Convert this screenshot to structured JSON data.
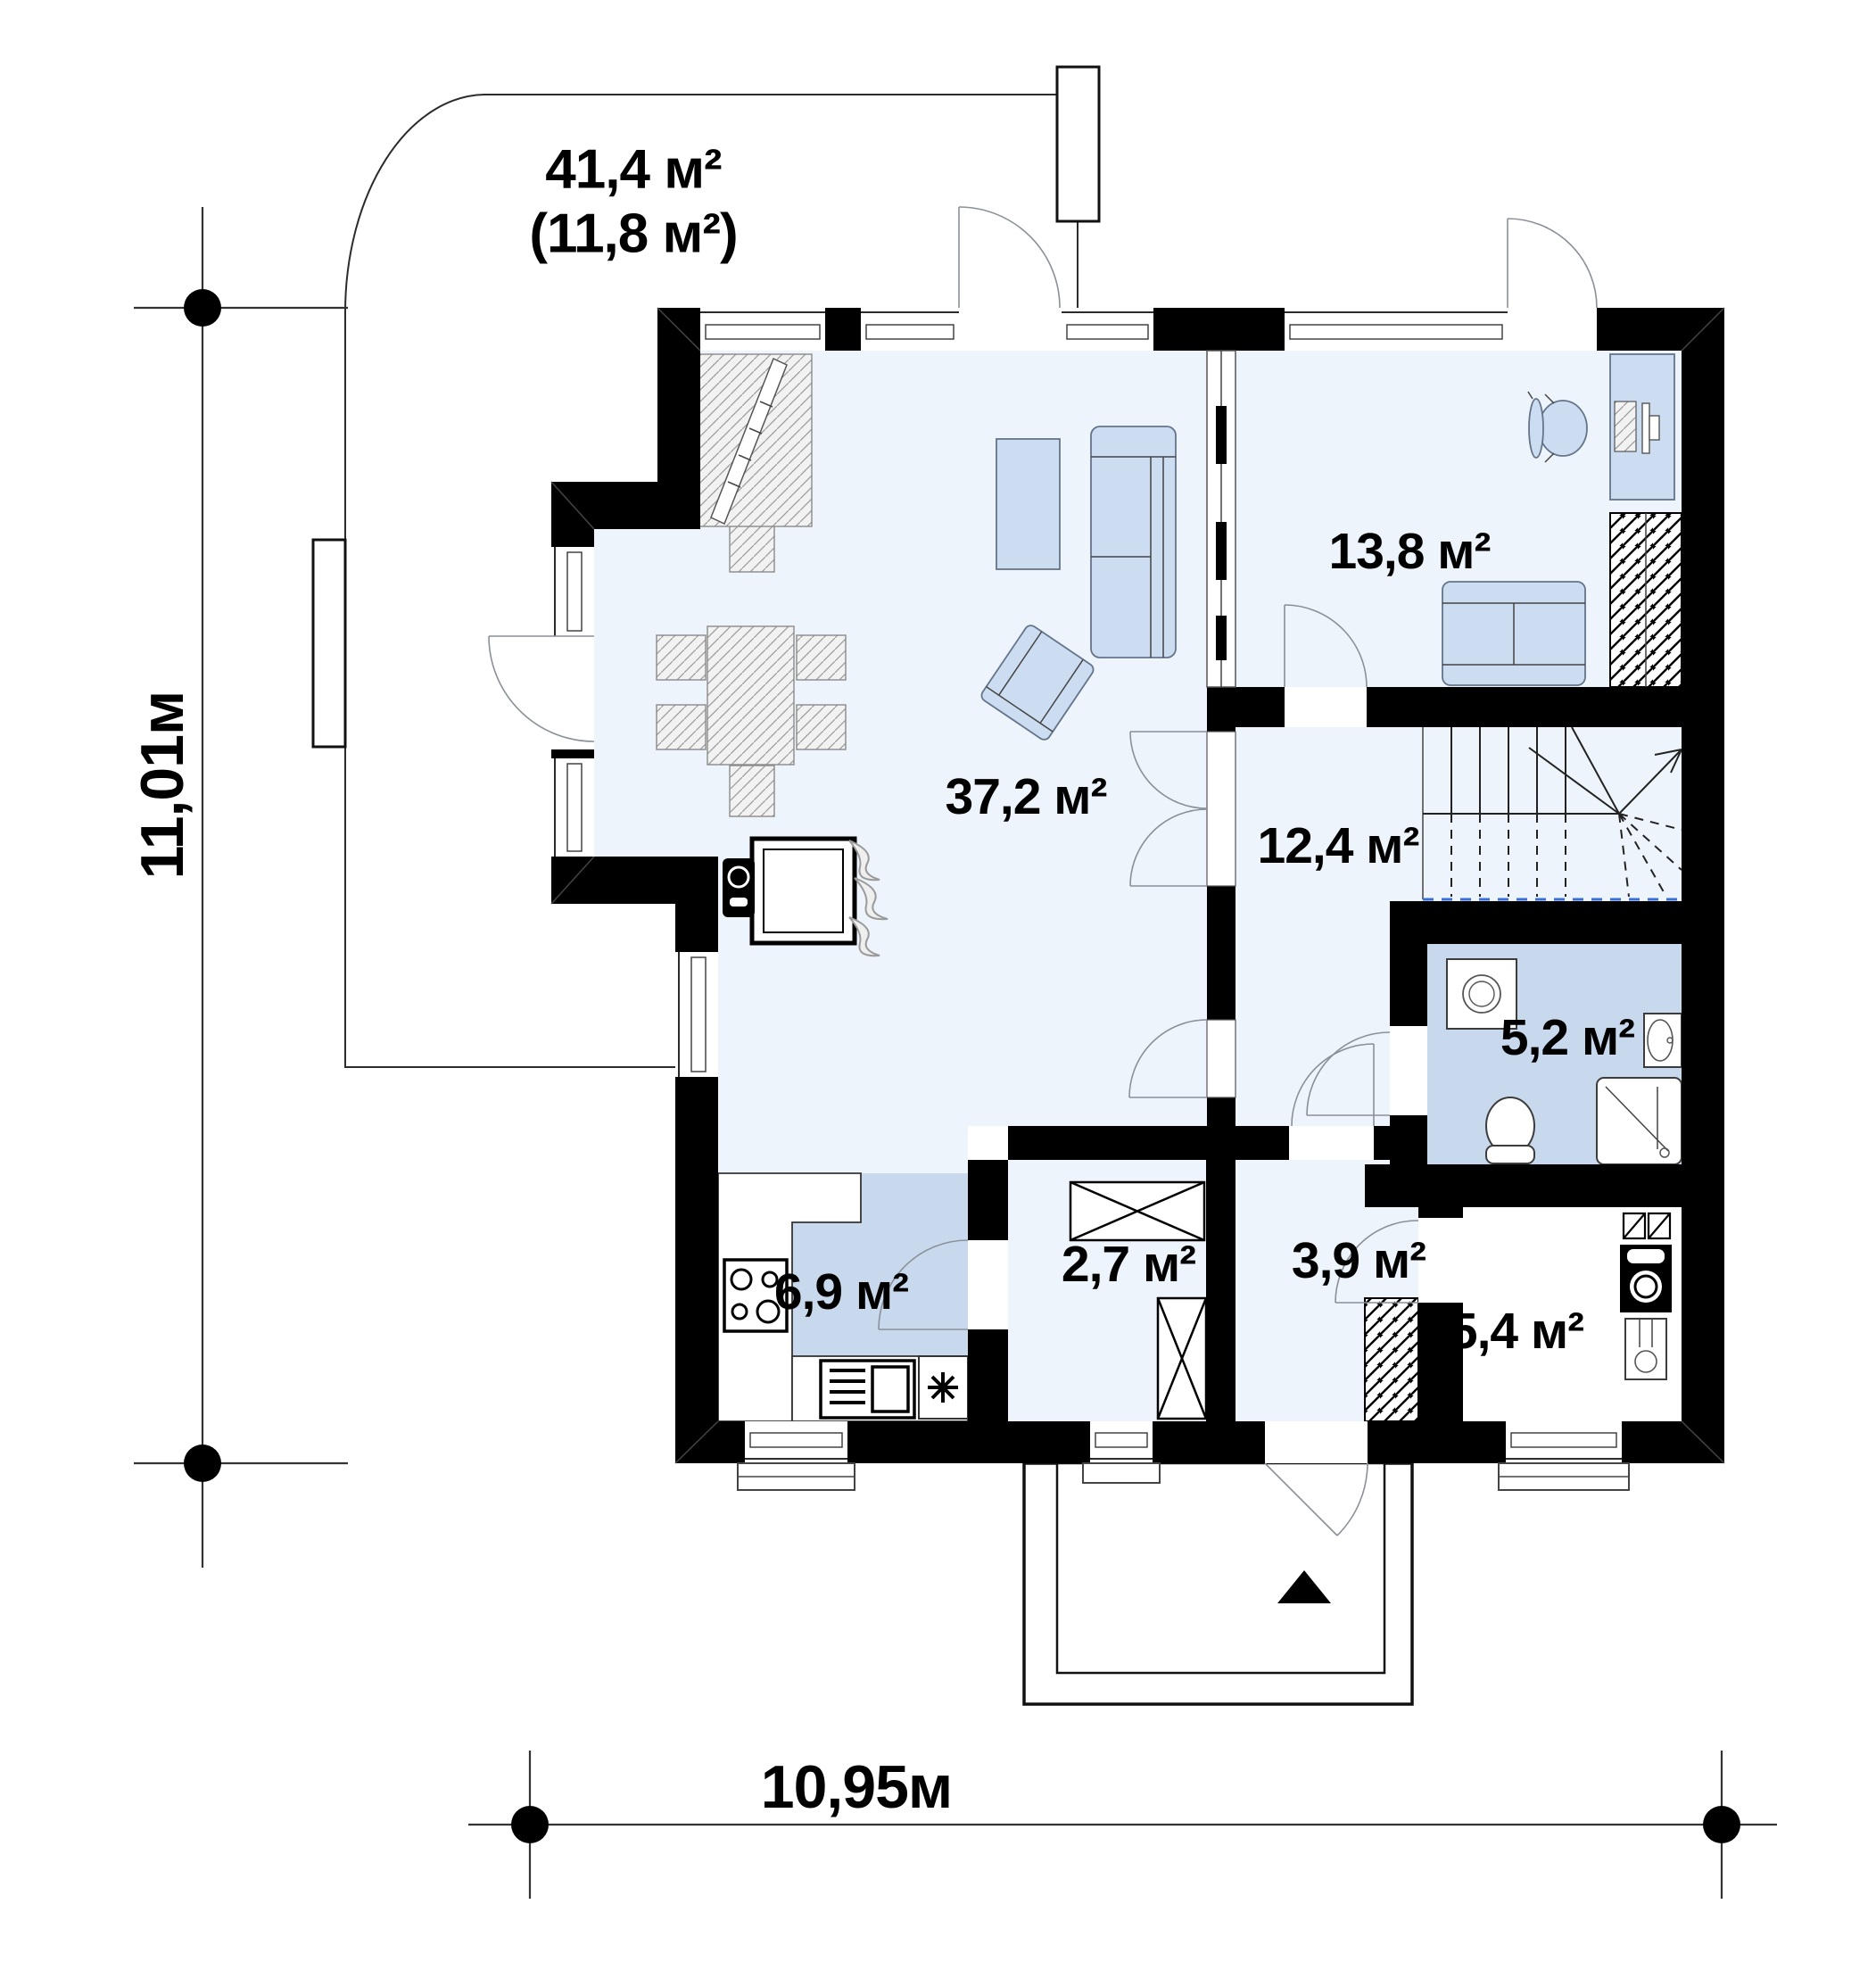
{
  "plan": {
    "type": "floor_plan",
    "terrace": {
      "area": "41,4 м²",
      "area_note": "(11,8 м²)"
    },
    "rooms": [
      {
        "name": "living-room",
        "area": "37,2 м²"
      },
      {
        "name": "office-room",
        "area": "13,8 м²"
      },
      {
        "name": "hall-stairs",
        "area": "12,4 м²"
      },
      {
        "name": "bathroom",
        "area": "5,2 м²"
      },
      {
        "name": "kitchen",
        "area": "6,9 м²"
      },
      {
        "name": "pantry",
        "area": "2,7 м²"
      },
      {
        "name": "entry-hall",
        "area": "3,9 м²"
      },
      {
        "name": "utility-room",
        "area": "5,4 м²"
      }
    ],
    "dimensions": {
      "height": "11,01м",
      "width": "10,95м"
    },
    "colors": {
      "wall": "#000000",
      "floor_light": "#edf4fb",
      "floor_blue": "#c9d9ed",
      "furniture_blue": "#ccdcf1",
      "stair_cut_line": "#3a6fd8"
    }
  }
}
